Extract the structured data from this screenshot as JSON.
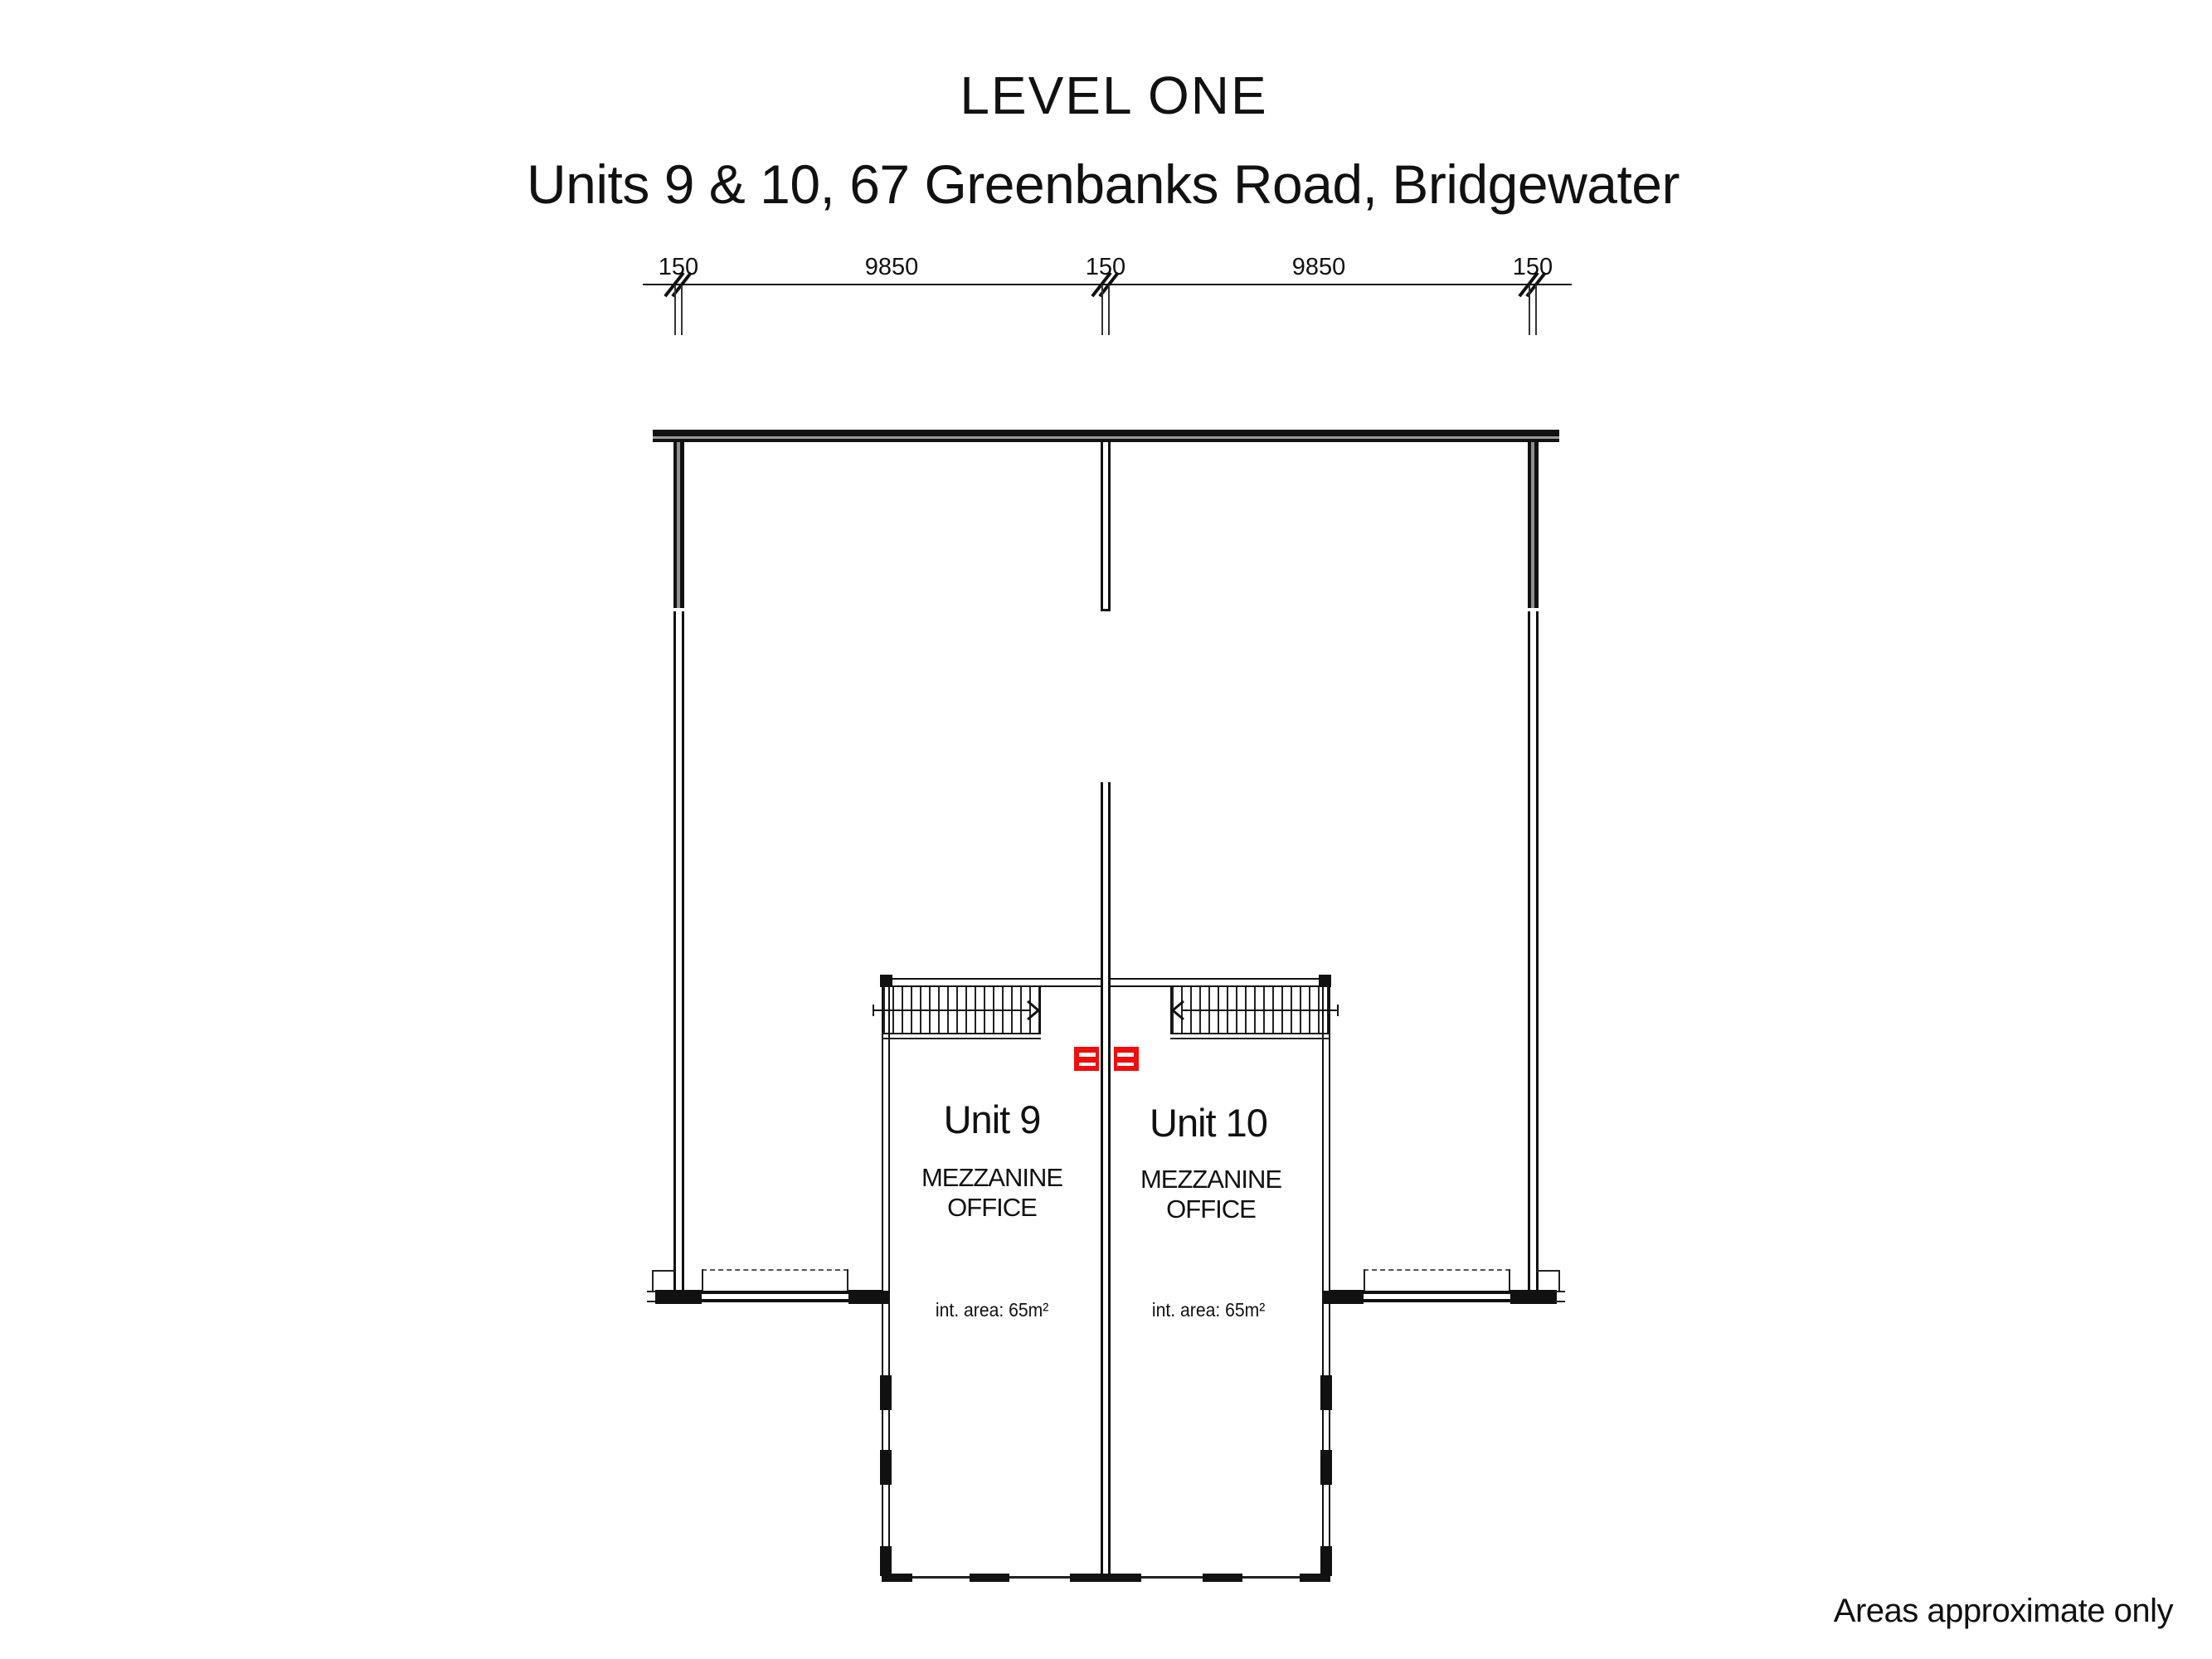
{
  "title": "LEVEL ONE",
  "subtitle": "Units 9 & 10, 67 Greenbanks Road, Bridgewater",
  "dimensions": {
    "labels": [
      "150",
      "9850",
      "150",
      "9850",
      "150"
    ]
  },
  "units": [
    {
      "name": "Unit 9",
      "room_line1": "MEZZANINE",
      "room_line2": "OFFICE",
      "area": "int. area: 65m²"
    },
    {
      "name": "Unit 10",
      "room_line1": "MEZZANINE",
      "room_line2": "OFFICE",
      "area": "int. area: 65m²"
    }
  ],
  "footnote": "Areas approximate only",
  "colors": {
    "drawing_black": "#111111",
    "symbol_red": "#f20d0d"
  }
}
